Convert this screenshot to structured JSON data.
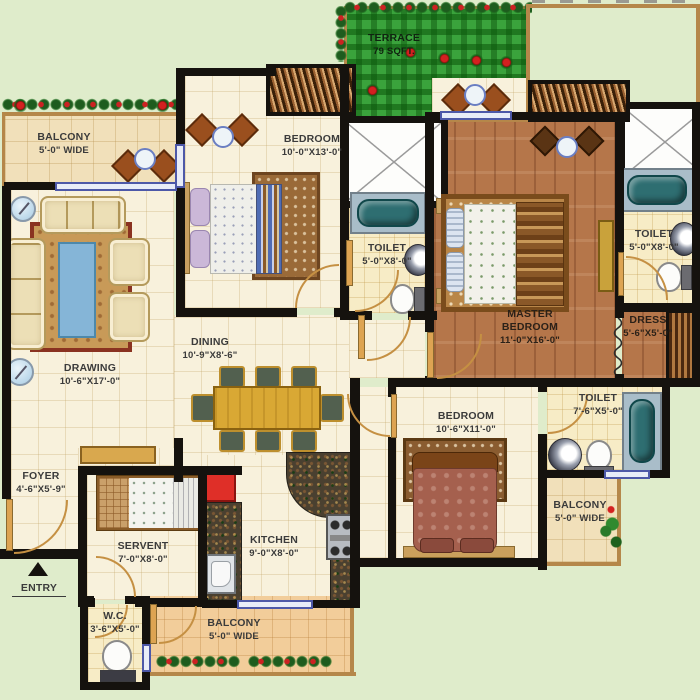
{
  "plan": {
    "type": "apartment-floor-plan",
    "entry_label": "ENTRY",
    "rooms": {
      "balcony_tl": {
        "name": "BALCONY",
        "dims": "5'-0\" WIDE"
      },
      "drawing": {
        "name": "DRAWING",
        "dims": "10'-6\"X17'-0\""
      },
      "bedroom_top": {
        "name": "BEDROOM",
        "dims": "10'-0\"X13'-0\""
      },
      "terrace": {
        "name": "TERRACE",
        "dims": "79 SQFT."
      },
      "toilet_mid": {
        "name": "TOILET",
        "dims": "5'-0\"X8'-0\""
      },
      "master_bedroom": {
        "name": "MASTER BEDROOM",
        "dims": "11'-0\"X16'-0\""
      },
      "toilet_right": {
        "name": "TOILET",
        "dims": "5'-0\"X8'-0\""
      },
      "dress": {
        "name": "DRESS",
        "dims": "5'-6\"X5'-0\""
      },
      "dining": {
        "name": "DINING",
        "dims": "10'-9\"X8'-6\""
      },
      "foyer": {
        "name": "FOYER",
        "dims": "4'-6\"X5'-9\""
      },
      "servant": {
        "name": "SERVENT",
        "dims": "7'-0\"X8'-0\""
      },
      "kitchen": {
        "name": "KITCHEN",
        "dims": "9'-0\"X8'-0\""
      },
      "wc": {
        "name": "W.C.",
        "dims": "3'-6\"X5'-0\""
      },
      "balcony_bottom": {
        "name": "BALCONY",
        "dims": "5'-0\" WIDE"
      },
      "bedroom_bottom": {
        "name": "BEDROOM",
        "dims": "10'-6\"X11'-0\""
      },
      "toilet_br": {
        "name": "TOILET",
        "dims": "7'-6\"X5'-0\""
      },
      "balcony_br": {
        "name": "BALCONY",
        "dims": "5'-0\" WIDE"
      }
    },
    "colors": {
      "wall": "#15120e",
      "window_blue": "#4d58a8",
      "terrace_green": "#3aa33c",
      "wood_brown": "#b5764a",
      "floor_cream": "#f8f1dc",
      "flower_red": "#cc2222",
      "door_tan": "#c59043"
    }
  }
}
